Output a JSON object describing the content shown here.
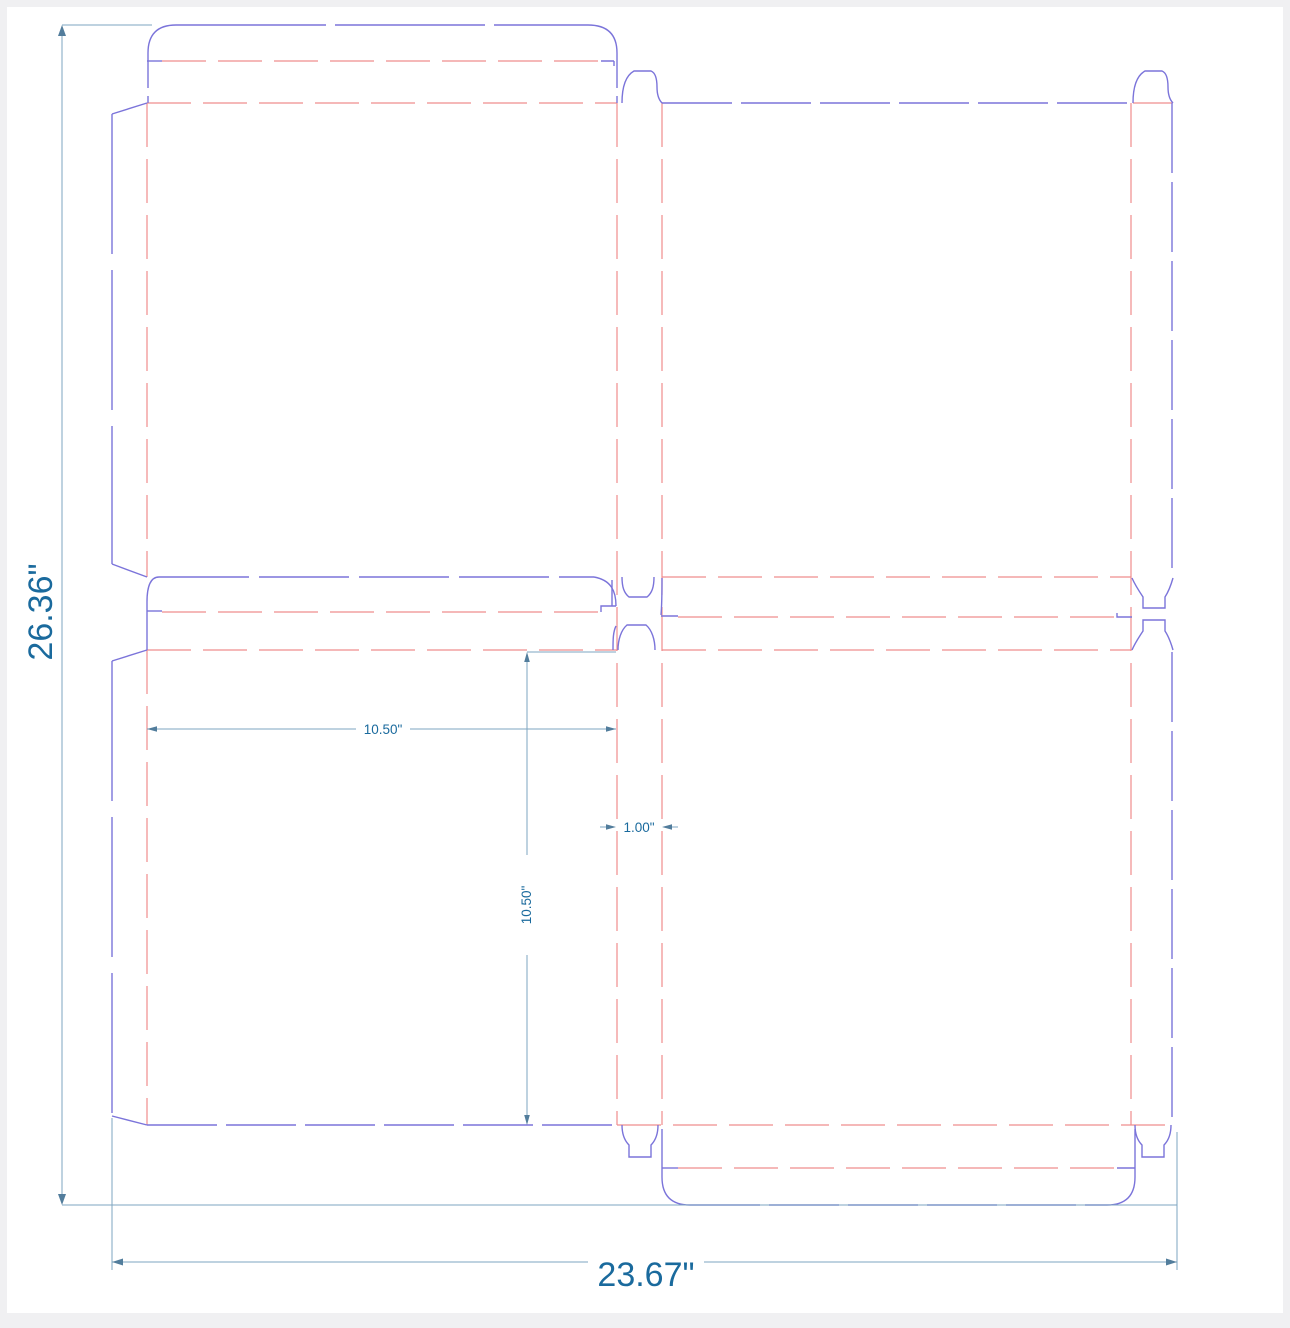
{
  "drawing": {
    "title": "box-dieline-template",
    "labels": {
      "overall_height": "26.36\"",
      "overall_width": "23.67\"",
      "panel_width": "10.50\"",
      "panel_height": "10.50\"",
      "gap_width": "1.00\""
    },
    "colors": {
      "cut": "#7b74da",
      "fold": "#ef8d8d",
      "dimension": "#7ea6c0",
      "dimension_dark": "#527d9c",
      "dimension_text": "#1a6a9d",
      "frame": "#f0f0f2"
    },
    "legend": {
      "cut_lines": "blue",
      "fold_lines": "red dashed",
      "dimension_lines": "steel blue"
    }
  }
}
